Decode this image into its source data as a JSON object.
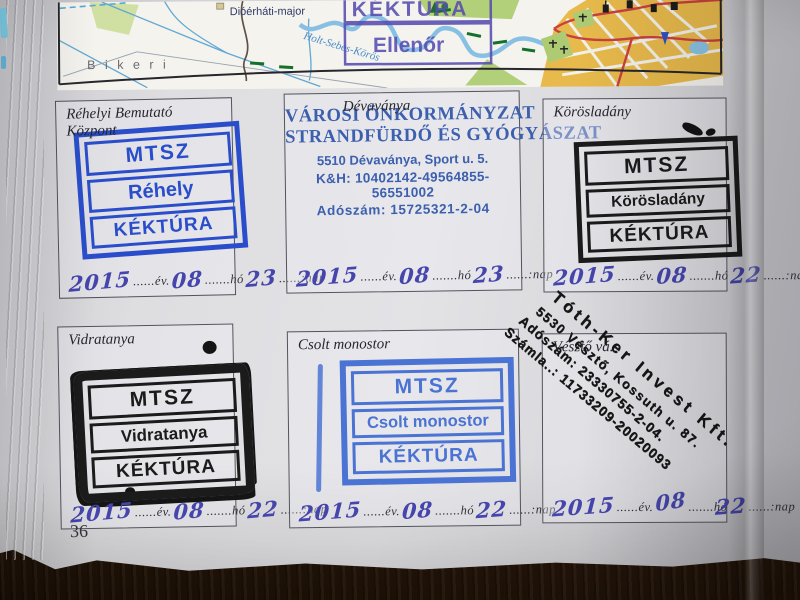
{
  "page": {
    "number": "36"
  },
  "map": {
    "label_major": "Dióérháti-major",
    "label_bikeri": "B i k e r i",
    "label_river": "Holt-Sebes-Körös",
    "control_stamp_top": "KÉKTÚRA",
    "control_stamp_bottom": "Ellenőr"
  },
  "date_labels": {
    "seg_ev": "......év.",
    "seg_ho": ".......hó",
    "seg_nap": "......:nap"
  },
  "colors": {
    "stamp_blue": "#2a4ecb",
    "stamp_blue_light": "#4a73d4",
    "stamp_black": "#1b1b1b",
    "handwriting_ink": "#4545ac",
    "org_stamp_blue": "#3c5fae",
    "control_stamp_purple": "#564cb0",
    "table_wood": "#3a2212"
  },
  "boxes": [
    {
      "title": "Réhelyi Bemutató Központ",
      "stamp_rows": [
        "MTSZ",
        "Réhely",
        "KÉKTÚRA"
      ],
      "date": {
        "y": "2015",
        "m": "08",
        "d": "23"
      }
    },
    {
      "title": "Dévaványa",
      "org_line1": "VÁROSI ÖNKORMÁNYZAT",
      "org_line2": "STRANDFÜRDŐ ÉS GYÓGYÁSZAT",
      "org_addr": "5510 Dévaványa, Sport u. 5.",
      "org_bank": "K&H: 10402142-49564855-56551002",
      "org_tax": "Adószám: 15725321-2-04",
      "date": {
        "y": "2015",
        "m": "08",
        "d": "23"
      }
    },
    {
      "title": "Körösladány",
      "stamp_rows": [
        "MTSZ",
        "Körösladány",
        "KÉKTÚRA"
      ],
      "date": {
        "y": "2015",
        "m": "08",
        "d": "22"
      }
    },
    {
      "title": "Vidratanya",
      "stamp_rows": [
        "MTSZ",
        "Vidratanya",
        "KÉKTÚRA"
      ],
      "date": {
        "y": "2015",
        "m": "08",
        "d": "22"
      }
    },
    {
      "title": "Csolt monostor",
      "stamp_rows": [
        "MTSZ",
        "Csolt monostor",
        "KÉKTÚRA"
      ],
      "date": {
        "y": "2015",
        "m": "08",
        "d": "22"
      }
    },
    {
      "title": "Vésztő vá.",
      "diag_lines": [
        "Tóth-Ker Invest Kft.",
        "5530 Vésztő, Kossuth u. 87.",
        "Adószám: 23330755-2-04.",
        "Számla..: 11733209-20020093"
      ],
      "date": {
        "y": "2015",
        "m": "08",
        "d": "22"
      }
    }
  ]
}
